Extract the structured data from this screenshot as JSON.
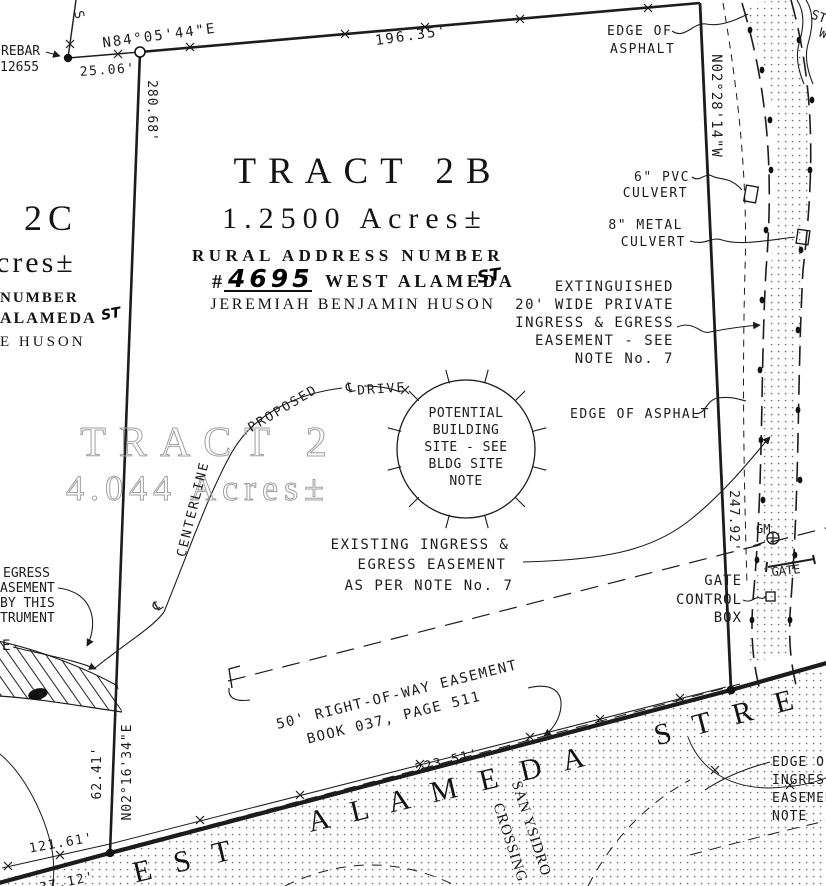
{
  "colors": {
    "ink": "#1c1c1c",
    "faded_text": "#9f9f9f",
    "paper": "#ffffff"
  },
  "tract2b": {
    "name": "TRACT 2B",
    "area": "1.2500 Acres±",
    "rural_line": "RURAL ADDRESS NUMBER",
    "hash": "#",
    "number": "4695",
    "street": "WEST ALAMEDA",
    "st": "ST",
    "owner": "JEREMIAH BENJAMIN HUSON"
  },
  "tract2c": {
    "name": "2C",
    "area_frag": "cres±",
    "rural_frag": "NUMBER",
    "street_frag": "ALAMEDA",
    "st": "ST",
    "owner_frag": "E HUSON"
  },
  "tract2": {
    "name": "TRACT 2",
    "area": "4.044 Acres±"
  },
  "street": {
    "west_frag": "E S T",
    "alameda": "A L A M E D A",
    "stre_frag": "S T R E",
    "san": "SAN YSIDRO",
    "crossing": "CROSSING"
  },
  "meas": {
    "bearing_top": "N84°05'44\"E",
    "d2506": "25.06'",
    "d19635": "196.35'",
    "d28068": "280.68'",
    "bearing_right": "N02°28'14\"W",
    "d24792": "247.92'",
    "d22351": "223.51'",
    "d12161": "121.61'",
    "d6241": "62.41'",
    "bearing_bl": "N02°16'34\"E",
    "d3712": "37.12'"
  },
  "notes": {
    "rebar": [
      "REBAR",
      "12655"
    ],
    "edge_top": [
      "EDGE OF",
      "ASPHALT"
    ],
    "pvc": [
      "6\" PVC",
      "CULVERT"
    ],
    "metal": [
      "8\" METAL",
      "CULVERT"
    ],
    "ext": [
      "EXTINGUISHED",
      "20' WIDE PRIVATE",
      "INGRESS & EGRESS",
      "EASEMENT - SEE",
      "NOTE No. 7"
    ],
    "edge_mid": "EDGE OF ASPHALT",
    "site": [
      "POTENTIAL",
      "BUILDING",
      "SITE - SEE",
      "BLDG SITE",
      "NOTE"
    ],
    "existing": [
      "EXISTING INGRESS &",
      "EGRESS EASEMENT",
      "AS PER NOTE No. 7"
    ],
    "gatebox": [
      "GATE",
      "CONTROL",
      "BOX"
    ],
    "row": [
      "50' RIGHT-OF-WAY EASEMENT",
      "BOOK 037, PAGE 511"
    ],
    "edge_ing": [
      "EDGE OF",
      "INGRESS",
      "EASEMENT",
      "NOTE"
    ],
    "egress_frag": [
      "EGRESS",
      "ASEMENT",
      "BY THIS",
      "TRUMENT",
      "E"
    ],
    "proposed": "PROPOSED",
    "drive": "DRIVE",
    "centerline": "CENTERLINE",
    "gm": "GM",
    "gate": "GATE",
    "frag_s": "S",
    "frag_st": "ST",
    "frag_w": "W",
    "cl": "℄"
  }
}
